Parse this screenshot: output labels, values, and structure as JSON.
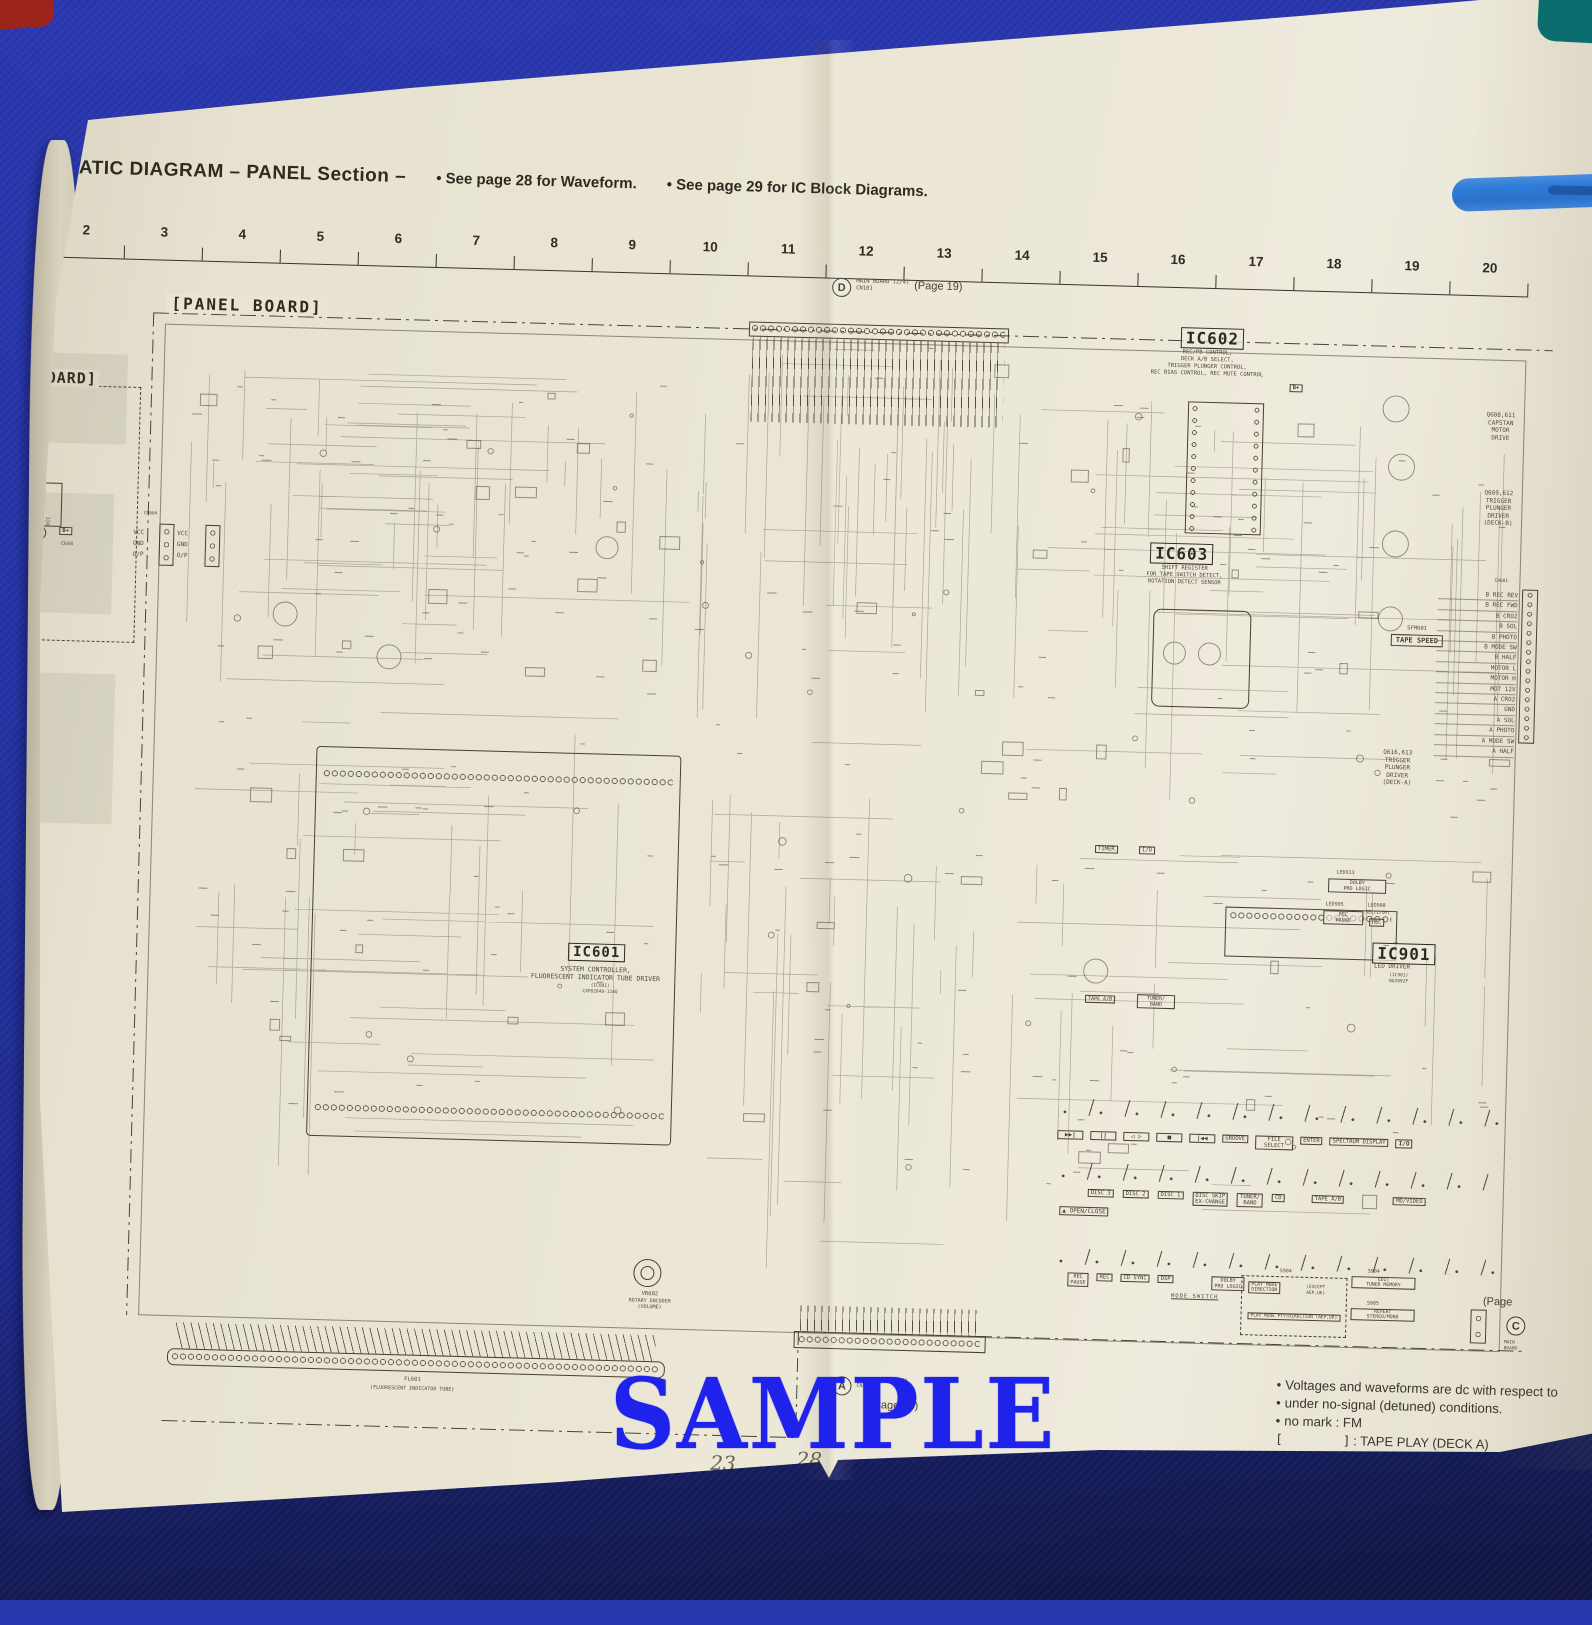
{
  "header": {
    "number": "3.",
    "title": "SCHEMATIC DIAGRAM  – PANEL Section –",
    "note_waveform": "• See page 28 for Waveform.",
    "note_ic": "• See page 29 for IC Block Diagrams."
  },
  "ruler": [
    "1",
    "2",
    "3",
    "4",
    "5",
    "6",
    "7",
    "8",
    "9",
    "10",
    "11",
    "12",
    "13",
    "14",
    "15",
    "16",
    "17",
    "18",
    "19",
    "20"
  ],
  "panel_board_label": "[PANEL BOARD]",
  "sensor_board": {
    "title": "[SENSOR BOARD]",
    "ref": "RM601",
    "desc_lines": [
      "REMOTE",
      "CONTROL",
      "RECEIVER"
    ],
    "pin_labels": [
      "IROUT",
      "GND",
      "VCC"
    ],
    "pin_numbers": [
      "1",
      "2",
      "3"
    ],
    "bplus": "B+",
    "cap_ref": "C644",
    "signals": [
      "VCC",
      "GND",
      "O/P"
    ],
    "conn_ref": "CN604"
  },
  "connector_d": {
    "letter": "D",
    "board": "MAIN BOARD (2/4)",
    "conn": "CN101",
    "page": "(Page 19)"
  },
  "connector_a": {
    "letter": "A",
    "board": "DECKB BOARD (1/4)",
    "conn": "CN705",
    "page": "(Page 13)"
  },
  "connector_c": {
    "letter": "C",
    "page": "(Page",
    "board": "MAIN",
    "board2": "BOARD"
  },
  "ic601": {
    "ref": "IC601",
    "desc": [
      "SYSTEM CONTROLLER,",
      "FLUORESCENT INDICATOR TUBE DRIVER"
    ],
    "part": "(IC601)",
    "part_no": "CXP82848-114Q"
  },
  "ic602": {
    "ref": "IC602",
    "desc": [
      "REC/PB CONTROL,",
      "DECK A/B SELECT,",
      "TRIGGER PLUNGER CONTROL,",
      "REC BIAS CONTROL, REC MUTE CONTROL"
    ],
    "bplus": "B+"
  },
  "ic603": {
    "ref": "IC603",
    "desc": [
      "SHIFT REGISTER",
      "FOR TAPE SWITCH DETECT,",
      "ROTATION DETECT SENSOR"
    ]
  },
  "ic901": {
    "ref": "IC901",
    "desc": "LED DRIVER",
    "part": "(IC901)",
    "part_no": "BU2092F"
  },
  "annotations": {
    "capstan": [
      "Q608,611",
      "CAPSTAN",
      "MOTOR",
      "DRIVE"
    ],
    "trigger_b": [
      "Q609,612",
      "TRIGGER",
      "PLUNGER",
      "DRIVER",
      "(DECK-B)"
    ],
    "trigger_a": [
      "Q616,613",
      "TRIGGER",
      "PLUNGER",
      "DRIVER",
      "(DECK-A)"
    ]
  },
  "tape_speed": {
    "ref": "SFM601",
    "label": "TAPE SPEED"
  },
  "cn601": "CN601",
  "right_pins": [
    "B REC REV",
    "B REC FWD",
    "B CRO2",
    "B SOL",
    "B PHOTO",
    "B MODE SW",
    "B HALF",
    "MOTOR L",
    "MOTOR H",
    "MOT 12V",
    "A CRO2",
    "GND",
    "A SOL",
    "A PHOTO",
    "A MODE SW",
    "A HALF"
  ],
  "led_labels": {
    "led913": "LED913",
    "dolby": [
      "DOLBY",
      "PRO LOGIC"
    ],
    "led905": "LED905",
    "rec_pause": [
      "REC",
      "PAUSE"
    ],
    "led908": "LED908",
    "sel": "SEL(1/2M)",
    "rec": "REC",
    "timer": "TIMER",
    "power": "I/O",
    "tape_ab": "TAPE A/B",
    "tuner_band": [
      "TUNER/",
      "BAND"
    ]
  },
  "buttons": {
    "transport": [
      "▶▶|",
      "||",
      "◁ ▷",
      "■",
      "|◀◀"
    ],
    "groove": "GROOVE",
    "file_select": [
      "FILE",
      "SELECT"
    ],
    "enter": "ENTER",
    "spectrum": "SPECTRUM DISPLAY",
    "power": "I/O",
    "disc": [
      "DISC 3",
      "DISC 2",
      "DISC 1"
    ],
    "disc_skip": [
      "DISC SKIP",
      "EX-CHANGE"
    ],
    "tuner_band": [
      "TUNER/",
      "BAND"
    ],
    "cd": "CD",
    "tape_ab": "TAPE A/B",
    "md_video": "MD/VIDEO",
    "open_close": "▲ OPEN/CLOSE",
    "rec_pause": [
      "REC",
      "PAUSE"
    ],
    "rec": "REC",
    "cd_sync": "CD SYNC",
    "dsp": "DSP",
    "dolby": [
      "DOLBY",
      "PRO LOGIC"
    ],
    "mode_switch": "MODE SWITCH",
    "s904": "S904",
    "play_mode1": [
      "PLAY MODE",
      "DIRECTION"
    ],
    "except": [
      "(EXCEPT",
      "AEP,UK)"
    ],
    "play_mode2": "PLAY MODE  PTY/DIRECTION  (AEP,UK)",
    "s904b": "S904",
    "edit": [
      "EDIT",
      "TUNER MEMORY"
    ],
    "s905": "S905",
    "repeat": [
      "REPEAT",
      "STEREO/MONO"
    ]
  },
  "vr602": {
    "ref": "VR602",
    "label": [
      "ROTARY ENCODER",
      "(VOLUME)"
    ]
  },
  "fl601": {
    "ref": "FL601",
    "label": "(FLUORESCENT INDICATOR TUBE)"
  },
  "notes": {
    "para": [
      "Voltages and waveforms are dc with respect to",
      "under no-signal (detuned) conditions.",
      "no mark : FM"
    ],
    "legend": [
      {
        "sym": "[        ]",
        "text": ": TAPE PLAY (DECK A)"
      },
      {
        "sym": "<        >",
        "text": ": TAPE PLAY (DECK B)"
      },
      {
        "sym": "((      ))",
        "text": ": TAPE REC"
      },
      {
        "sym": "    *",
        "text": ": Impossible to measure"
      }
    ]
  },
  "page_numbers": {
    "left": "23",
    "right": "28"
  },
  "watermark": "SAMPLE"
}
